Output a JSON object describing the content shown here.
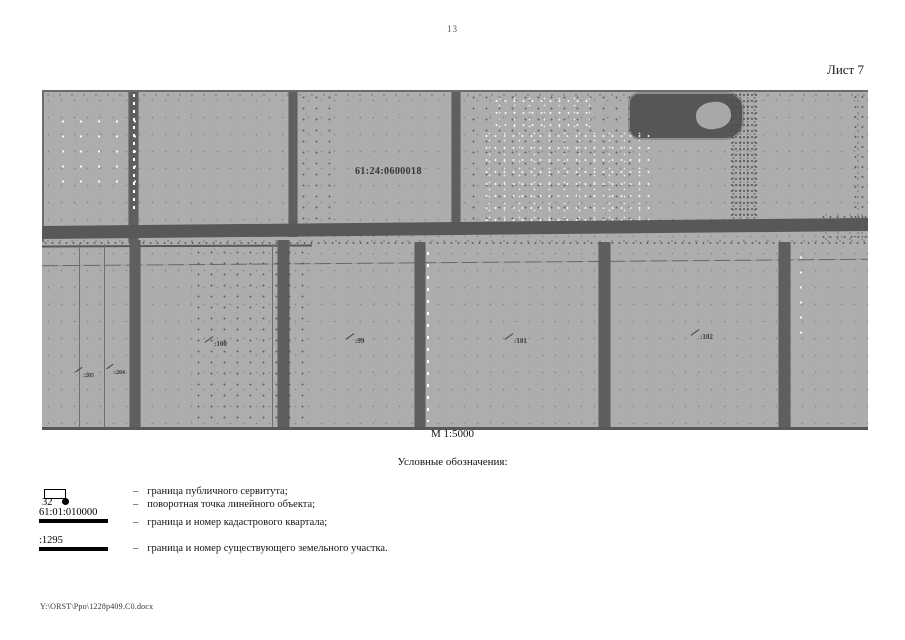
{
  "page": {
    "number": "13",
    "sheet_label": "Лист 7",
    "footer_path": "Y:\\ORST\\Ppo\\1228p409.C0.docx"
  },
  "map": {
    "cadastral_quarter_label": "61:24:0600018",
    "scale_label": "М 1:5000",
    "parcel_labels": [
      {
        "text": ":205"
      },
      {
        "text": ":204"
      },
      {
        "text": ":100"
      },
      {
        "text": ":99"
      },
      {
        "text": ":101"
      },
      {
        "text": ":102"
      }
    ],
    "colors": {
      "base_gray": "#adadad",
      "feature_dark": "#5f5f5f",
      "label_dark": "#3a3a3a"
    }
  },
  "legend": {
    "title": "Условные обозначения:",
    "dash": "–",
    "items": [
      {
        "symbol": "rectangle-outline",
        "symbol_text": "",
        "description": "граница публичного сервитута;"
      },
      {
        "symbol": "numbered-point",
        "symbol_text": "32",
        "description": "поворотная точка линейного объекта;"
      },
      {
        "symbol": "thick-line",
        "symbol_text": "61:01:010000",
        "description": "граница и номер кадастрового квартала;"
      },
      {
        "symbol": "thick-line",
        "symbol_text": ":1295",
        "description": "граница и номер существующего земельного участка."
      }
    ]
  }
}
